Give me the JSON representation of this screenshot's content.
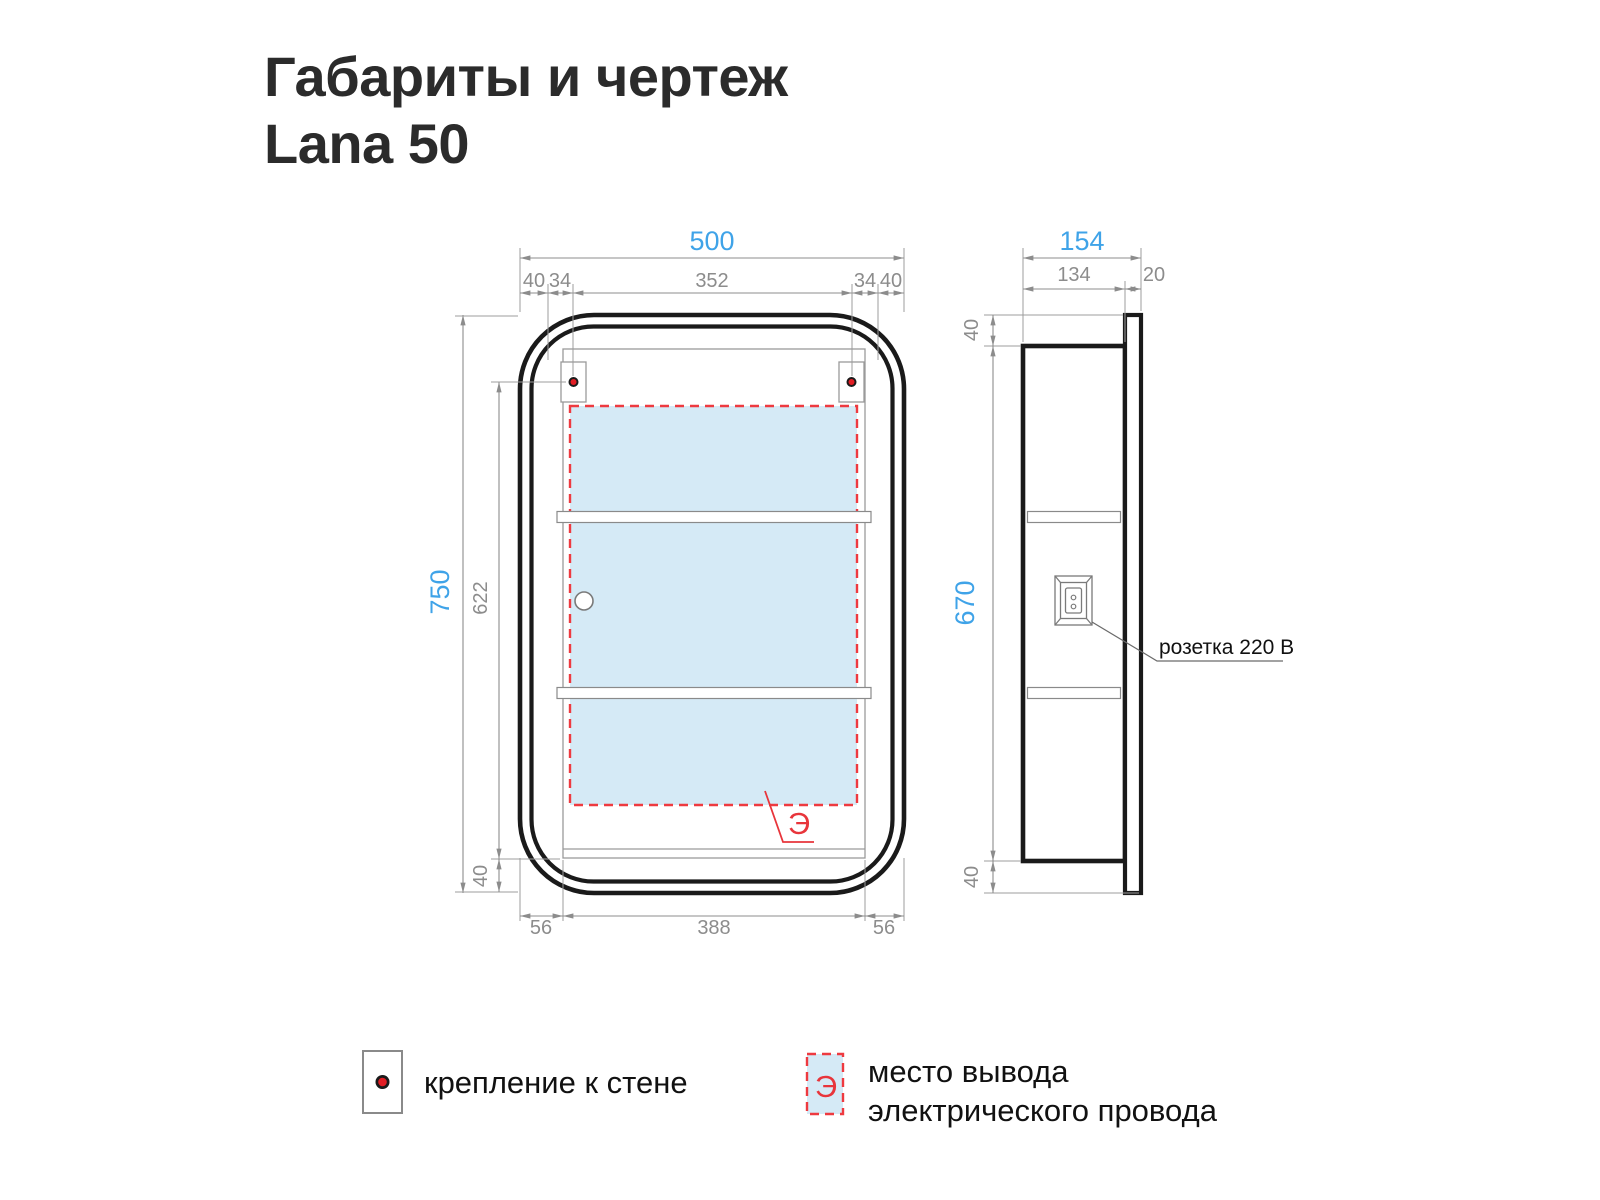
{
  "title": {
    "line1": "Габариты и чертеж",
    "line2": "Lana 50"
  },
  "front_view": {
    "dim_width_total": "500",
    "dim_top_segments": [
      "40",
      "34",
      "352",
      "34",
      "40"
    ],
    "dim_height_total": "750",
    "dim_inner_height": "622",
    "dim_bottom_gap": "40",
    "dim_bottom_segments": [
      "56",
      "388",
      "56"
    ],
    "electric_outlet_symbol": "Э"
  },
  "side_view": {
    "dim_width_total": "154",
    "dim_body_depth": "134",
    "dim_door_depth": "20",
    "dim_top_gap": "40",
    "dim_body_height": "670",
    "dim_bottom_gap": "40",
    "socket_label": "розетка 220 В"
  },
  "legend": {
    "mount_label": "крепление к стене",
    "electric_symbol": "Э",
    "electric_label_line1": "место вывода",
    "electric_label_line2": "электрического провода"
  },
  "colors": {
    "accent_blue": "#3FA3E8",
    "dim_gray": "#8C8C8C",
    "marker_red": "#EE3A40",
    "panel_blue": "#D5EAF6",
    "line_black": "#1A1A1A"
  }
}
